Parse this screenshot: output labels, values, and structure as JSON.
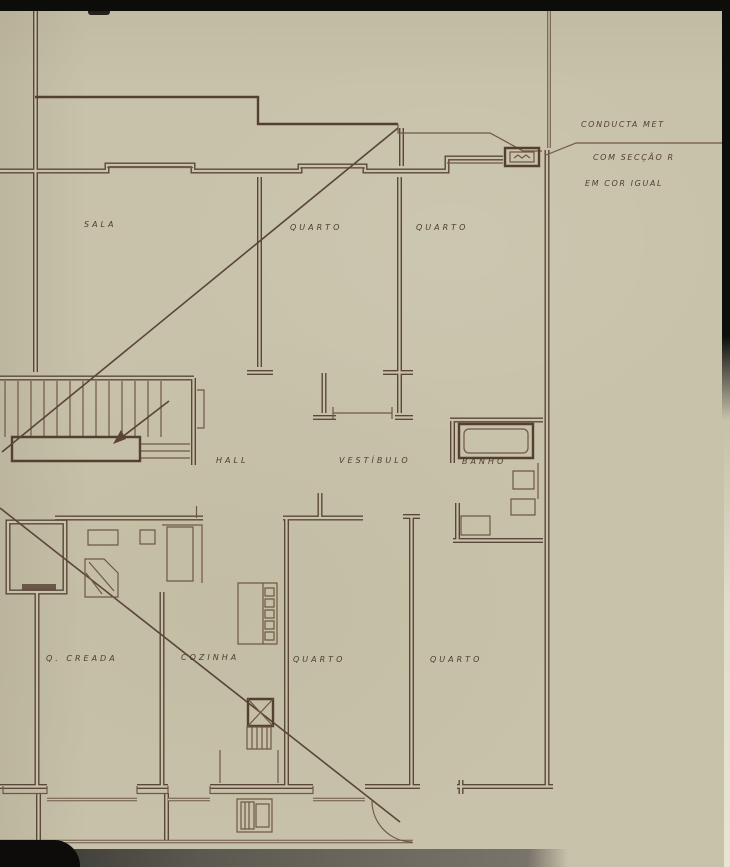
{
  "document": {
    "type": "hand-drawn architectural floor plan",
    "language": "Portuguese",
    "medium": "sepia ink on aged paper"
  },
  "rooms": {
    "sala": "SALA",
    "quarto_top_1": "QUARTO",
    "quarto_top_2": "QUARTO",
    "hall": "HALL",
    "vestibulo": "VESTÍBULO",
    "banho": "BANHO",
    "quarto_creada": "Q. CREADA",
    "cozinha": "COZINHA",
    "quarto_bottom_1": "QUARTO",
    "quarto_bottom_2": "QUARTO"
  },
  "annotation": {
    "line1": "CONDUCTA MET",
    "line2": "COM SECÇÃO R",
    "line3": "EM COR IGUAL"
  },
  "colors": {
    "paper": "#c8c2aa",
    "ink": "#5a4638",
    "edge_dark": "#0c0c0b"
  }
}
